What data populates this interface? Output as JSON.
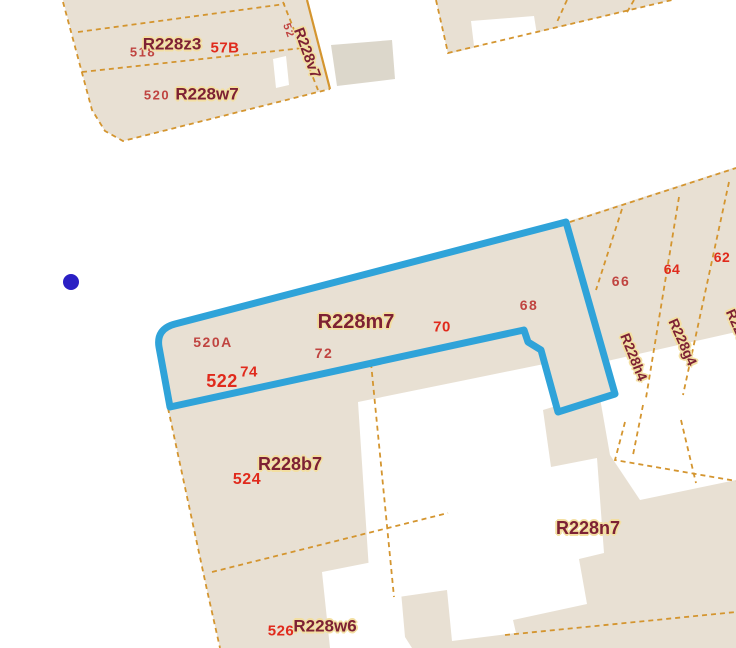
{
  "colors": {
    "background": "#ffffff",
    "parcel_fill": "#e8e0d3",
    "building_gray": "#dcd7cb",
    "building_white": "#ffffff",
    "boundary_line": "#d4952f",
    "highlight_outline": "#2fa3d9",
    "marker_blue": "#2a1fc4",
    "address_red": "#c04440",
    "address_red_bold": "#e02a1c",
    "parcel_label_maroon": "#7d2134",
    "label_halo": "#f3dfa2"
  },
  "map": {
    "marker": {
      "name": "selected-point-marker",
      "x": 71,
      "y": 282
    },
    "highlighted_parcel": {
      "id": "R228m7",
      "address_numbers": [
        "520A",
        "522",
        "74",
        "72",
        "70",
        "68"
      ]
    },
    "labels": [
      {
        "name": "addr-518",
        "text": "518",
        "x": 143,
        "y": 52,
        "rot": 0,
        "size": 13,
        "style": "addr"
      },
      {
        "name": "parcel-label-r228z3",
        "text": "R228z3",
        "x": 172,
        "y": 44,
        "rot": 0,
        "size": 17,
        "style": "pid"
      },
      {
        "name": "addr-57b",
        "text": "57B",
        "x": 225,
        "y": 48,
        "rot": 0,
        "size": 15,
        "style": "addr-bold"
      },
      {
        "name": "addr-520",
        "text": "520",
        "x": 157,
        "y": 95,
        "rot": 0,
        "size": 13,
        "style": "addr"
      },
      {
        "name": "parcel-label-r228w7",
        "text": "R228w7",
        "x": 207,
        "y": 94,
        "rot": 0,
        "size": 17,
        "style": "pid"
      },
      {
        "name": "addr-52",
        "text": "52",
        "x": 288,
        "y": 31,
        "rot": 70,
        "size": 11,
        "style": "addr"
      },
      {
        "name": "parcel-label-r228v7",
        "text": "R228v7",
        "x": 307,
        "y": 53,
        "rot": 70,
        "size": 15,
        "style": "pid"
      },
      {
        "name": "addr-520a",
        "text": "520A",
        "x": 213,
        "y": 342,
        "rot": 0,
        "size": 14,
        "style": "addr"
      },
      {
        "name": "addr-522",
        "text": "522",
        "x": 222,
        "y": 381,
        "rot": 0,
        "size": 18,
        "style": "addr-bold"
      },
      {
        "name": "addr-74",
        "text": "74",
        "x": 249,
        "y": 372,
        "rot": 0,
        "size": 15,
        "style": "addr-bold"
      },
      {
        "name": "addr-72",
        "text": "72",
        "x": 324,
        "y": 353,
        "rot": 0,
        "size": 14,
        "style": "addr"
      },
      {
        "name": "parcel-label-r228m7",
        "text": "R228m7",
        "x": 356,
        "y": 322,
        "rot": 0,
        "size": 20,
        "style": "pid"
      },
      {
        "name": "addr-70",
        "text": "70",
        "x": 442,
        "y": 327,
        "rot": 0,
        "size": 15,
        "style": "addr-bold"
      },
      {
        "name": "addr-68",
        "text": "68",
        "x": 529,
        "y": 305,
        "rot": 0,
        "size": 14,
        "style": "addr"
      },
      {
        "name": "addr-66",
        "text": "66",
        "x": 621,
        "y": 281,
        "rot": 0,
        "size": 14,
        "style": "addr"
      },
      {
        "name": "addr-64",
        "text": "64",
        "x": 672,
        "y": 269,
        "rot": 0,
        "size": 14,
        "style": "addr-bold"
      },
      {
        "name": "addr-62",
        "text": "62",
        "x": 722,
        "y": 257,
        "rot": 0,
        "size": 14,
        "style": "addr-bold"
      },
      {
        "name": "parcel-label-r228h4",
        "text": "R228h4",
        "x": 634,
        "y": 357,
        "rot": 68,
        "size": 14,
        "style": "pid"
      },
      {
        "name": "parcel-label-r228g4",
        "text": "R228g4",
        "x": 683,
        "y": 342,
        "rot": 66,
        "size": 14,
        "style": "pid"
      },
      {
        "name": "parcel-label-edge-partial",
        "text": "R228",
        "x": 737,
        "y": 325,
        "rot": 66,
        "size": 14,
        "style": "pid"
      },
      {
        "name": "parcel-label-r228b7",
        "text": "R228b7",
        "x": 290,
        "y": 464,
        "rot": 0,
        "size": 18,
        "style": "pid"
      },
      {
        "name": "addr-524",
        "text": "524",
        "x": 247,
        "y": 480,
        "rot": 0,
        "size": 16,
        "style": "addr-bold"
      },
      {
        "name": "parcel-label-r228n7",
        "text": "R228n7",
        "x": 588,
        "y": 528,
        "rot": 0,
        "size": 18,
        "style": "pid"
      },
      {
        "name": "parcel-label-r228w6",
        "text": "R228w6",
        "x": 325,
        "y": 626,
        "rot": 0,
        "size": 17,
        "style": "pid"
      },
      {
        "name": "addr-526",
        "text": "526",
        "x": 281,
        "y": 631,
        "rot": 0,
        "size": 15,
        "style": "addr-bold"
      }
    ]
  }
}
